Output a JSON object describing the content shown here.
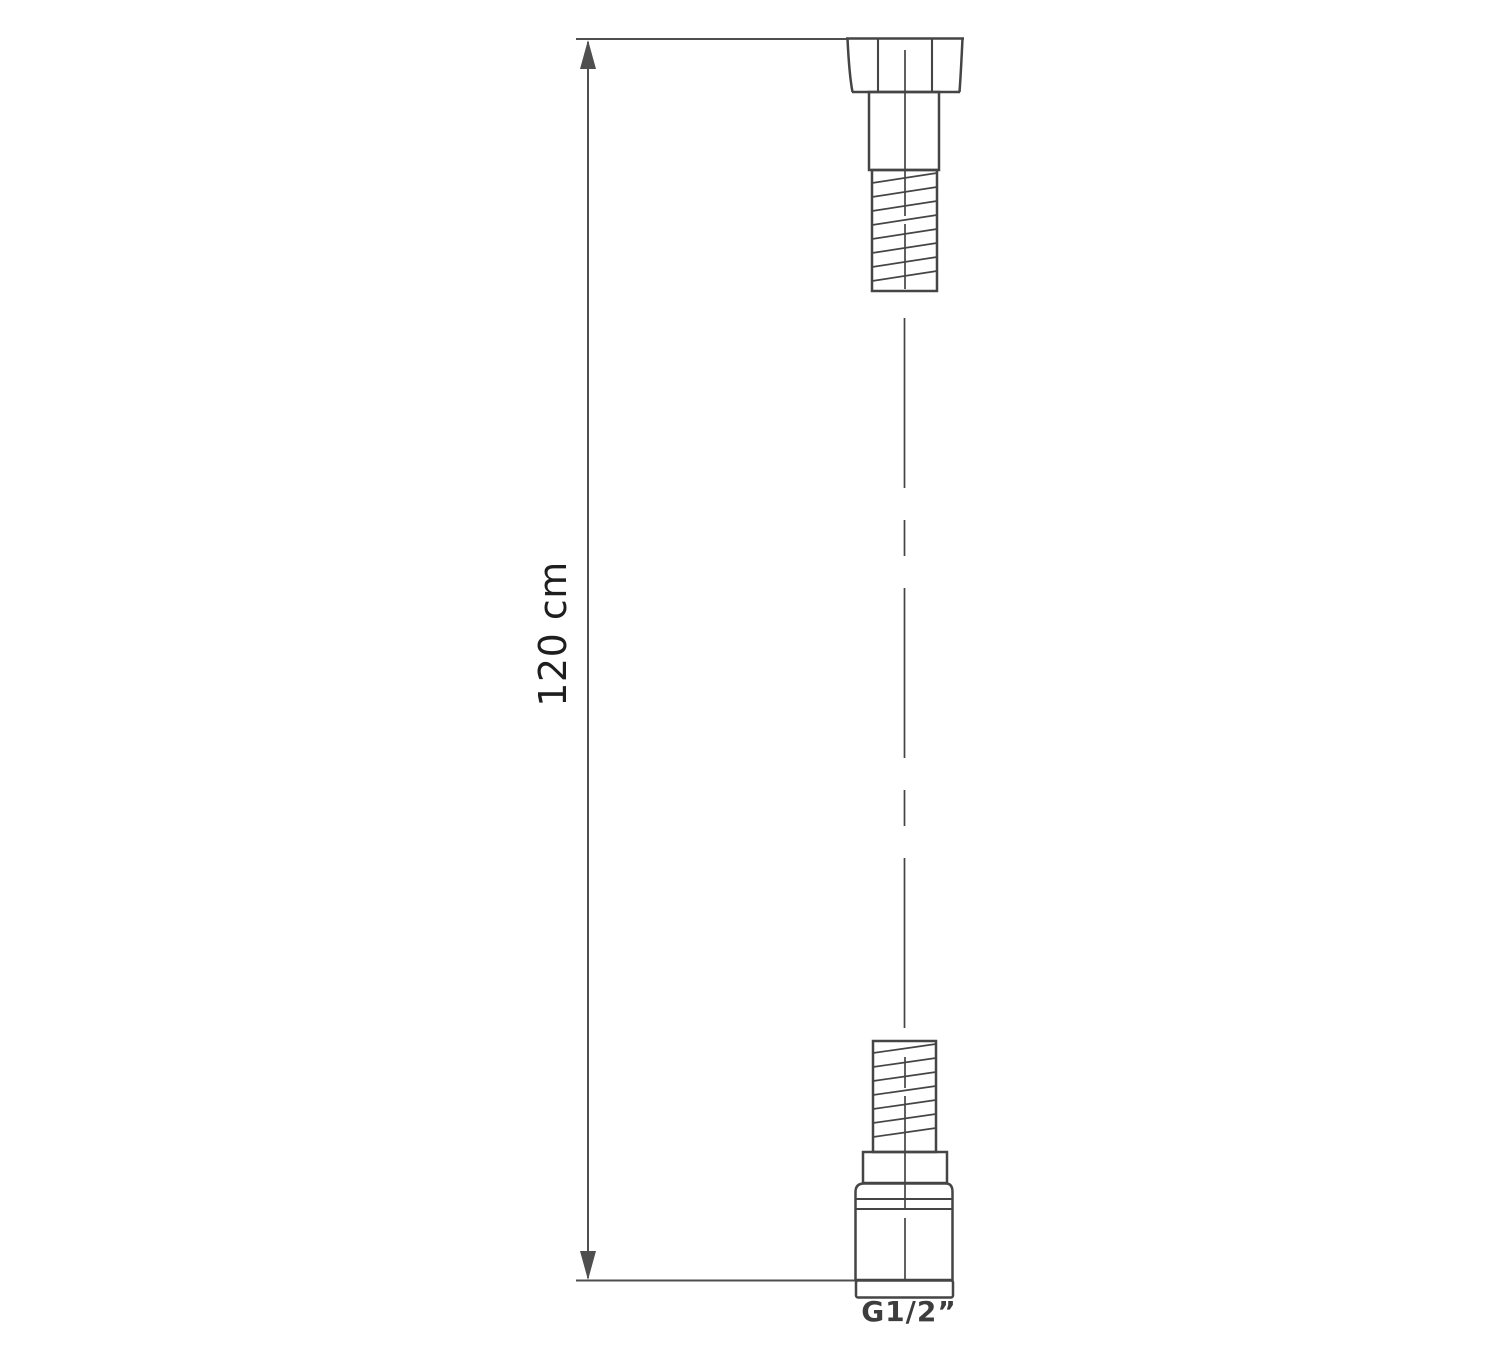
{
  "diagram": {
    "type": "technical-drawing",
    "dimension_label": "120 cm",
    "thread_label": "G1/2”"
  },
  "colors": {
    "background": "#ffffff",
    "line": "#454545",
    "dimension": "#4f4f4f",
    "label_text": "#1e1e1e",
    "thread_label_text": "#3d3d3d"
  }
}
